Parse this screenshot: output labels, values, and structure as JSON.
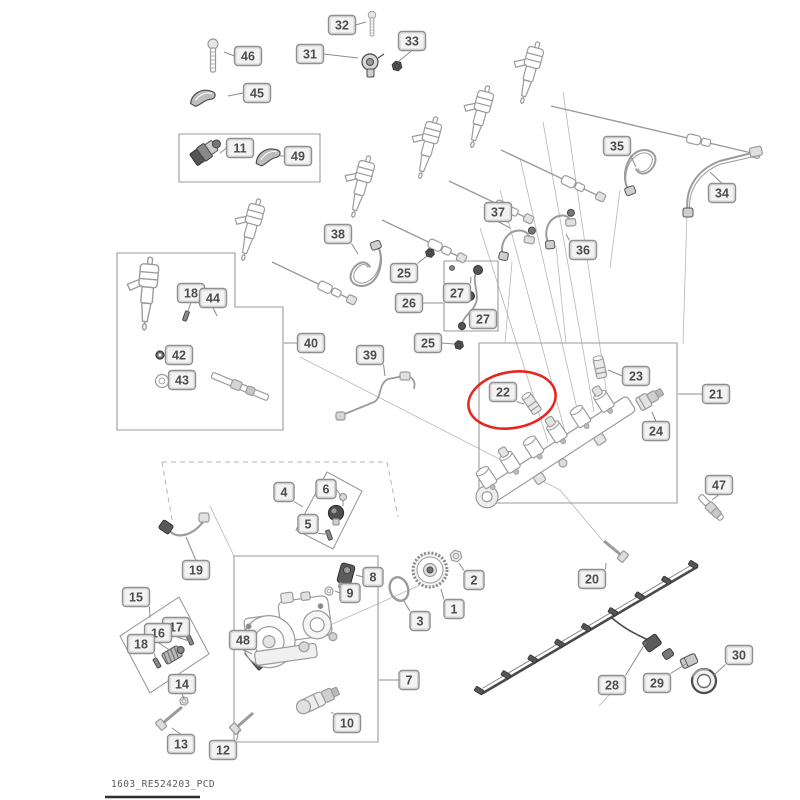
{
  "title": "Fuel system exploded parts diagram",
  "footer": {
    "doc_code": "1603_RE524203_PCD"
  },
  "colors": {
    "line": "#9b9b9b",
    "dark": "#4a4a4a",
    "construction": "#b6b6b6",
    "label_fill": "#f3f3f3",
    "label_stroke": "#8f8f8f",
    "label_inner": "#cfcfcf",
    "label_text": "#4c4c4c",
    "highlight_red": "#e8251f",
    "footer_rule": "#2f2f2f"
  },
  "highlight": {
    "label": "22",
    "cx": 512,
    "cy": 400,
    "rx": 44,
    "ry": 28,
    "rot": -10
  },
  "labels": [
    {
      "id": "46",
      "x": 248,
      "y": 56,
      "tx": 224,
      "ty": 52
    },
    {
      "id": "45",
      "x": 257,
      "y": 93,
      "tx": 228,
      "ty": 96
    },
    {
      "id": "32",
      "x": 342,
      "y": 25,
      "tx": 366,
      "ty": 22
    },
    {
      "id": "31",
      "x": 310,
      "y": 54,
      "tx": 358,
      "ty": 58
    },
    {
      "id": "33",
      "x": 412,
      "y": 41,
      "tx": 399,
      "ty": 61
    },
    {
      "id": "11",
      "x": 240,
      "y": 148,
      "tx": 220,
      "ty": 153
    },
    {
      "id": "49",
      "x": 298,
      "y": 156,
      "tx": 280,
      "ty": 156
    },
    {
      "id": "35",
      "x": 617,
      "y": 146,
      "tx": 636,
      "ty": 167
    },
    {
      "id": "34",
      "x": 722,
      "y": 193,
      "tx": 710,
      "ty": 172
    },
    {
      "id": "37",
      "x": 498,
      "y": 212,
      "tx": 510,
      "ty": 228
    },
    {
      "id": "36",
      "x": 583,
      "y": 250,
      "tx": 566,
      "ty": 234
    },
    {
      "id": "38",
      "x": 338,
      "y": 234,
      "tx": 358,
      "ty": 254
    },
    {
      "id": "25",
      "x": 404,
      "y": 273,
      "tx": 427,
      "ty": 256
    },
    {
      "id": "27",
      "x": 457,
      "y": 293,
      "tx": 471,
      "ty": 277
    },
    {
      "id": "26",
      "x": 409,
      "y": 303,
      "tx": 443,
      "ty": 303
    },
    {
      "id": "27",
      "x": 483,
      "y": 319,
      "tx": 470,
      "ty": 326
    },
    {
      "id": "25",
      "x": 428,
      "y": 343,
      "tx": 454,
      "ty": 344
    },
    {
      "id": "39",
      "x": 370,
      "y": 355,
      "tx": 385,
      "ty": 376
    },
    {
      "id": "40",
      "x": 311,
      "y": 343,
      "tx": 284,
      "ty": 343
    },
    {
      "id": "18",
      "x": 191,
      "y": 293,
      "tx": 187,
      "ty": 314
    },
    {
      "id": "44",
      "x": 213,
      "y": 298,
      "tx": 217,
      "ty": 316
    },
    {
      "id": "42",
      "x": 179,
      "y": 355,
      "tx": 166,
      "ty": 355
    },
    {
      "id": "43",
      "x": 182,
      "y": 380,
      "tx": 170,
      "ty": 381
    },
    {
      "id": "22",
      "x": 503,
      "y": 392,
      "tx": 524,
      "ty": 404
    },
    {
      "id": "23",
      "x": 636,
      "y": 376,
      "tx": 608,
      "ty": 370
    },
    {
      "id": "21",
      "x": 716,
      "y": 394,
      "tx": 678,
      "ty": 394
    },
    {
      "id": "24",
      "x": 656,
      "y": 431,
      "tx": 652,
      "ty": 412
    },
    {
      "id": "47",
      "x": 719,
      "y": 485,
      "tx": 712,
      "ty": 500
    },
    {
      "id": "19",
      "x": 196,
      "y": 570,
      "tx": 186,
      "ty": 537
    },
    {
      "id": "15",
      "x": 136,
      "y": 597,
      "tx": 150,
      "ty": 618
    },
    {
      "id": "17",
      "x": 176,
      "y": 627,
      "tx": 189,
      "ty": 641
    },
    {
      "id": "16",
      "x": 158,
      "y": 633,
      "tx": 171,
      "ty": 651
    },
    {
      "id": "18",
      "x": 141,
      "y": 644,
      "tx": 156,
      "ty": 662
    },
    {
      "id": "48",
      "x": 243,
      "y": 640,
      "tx": 252,
      "ty": 654
    },
    {
      "id": "14",
      "x": 182,
      "y": 684,
      "tx": 184,
      "ty": 699
    },
    {
      "id": "13",
      "x": 181,
      "y": 744,
      "tx": 172,
      "ty": 728
    },
    {
      "id": "12",
      "x": 223,
      "y": 750,
      "tx": 239,
      "ty": 730
    },
    {
      "id": "4",
      "x": 284,
      "y": 492,
      "tx": 303,
      "ty": 507
    },
    {
      "id": "6",
      "x": 326,
      "y": 489,
      "tx": 341,
      "ty": 496
    },
    {
      "id": "5",
      "x": 308,
      "y": 524,
      "tx": 327,
      "ty": 534
    },
    {
      "id": "8",
      "x": 373,
      "y": 577,
      "tx": 356,
      "ty": 575
    },
    {
      "id": "9",
      "x": 350,
      "y": 593,
      "tx": 335,
      "ty": 591
    },
    {
      "id": "2",
      "x": 474,
      "y": 580,
      "tx": 459,
      "ty": 563
    },
    {
      "id": "1",
      "x": 454,
      "y": 609,
      "tx": 441,
      "ty": 589
    },
    {
      "id": "3",
      "x": 420,
      "y": 621,
      "tx": 404,
      "ty": 601
    },
    {
      "id": "7",
      "x": 409,
      "y": 680,
      "tx": 379,
      "ty": 680
    },
    {
      "id": "10",
      "x": 347,
      "y": 723,
      "tx": 331,
      "ty": 712
    },
    {
      "id": "20",
      "x": 592,
      "y": 579,
      "tx": 606,
      "ty": 563
    },
    {
      "id": "28",
      "x": 612,
      "y": 685,
      "tx": 646,
      "ty": 642
    },
    {
      "id": "29",
      "x": 657,
      "y": 683,
      "tx": 686,
      "ty": 664
    },
    {
      "id": "30",
      "x": 739,
      "y": 655,
      "tx": 713,
      "ty": 676
    }
  ],
  "group_boxes": [
    {
      "name": "group-box-11-49",
      "points": "179,134 320,134 320,182 179,182"
    },
    {
      "name": "group-box-40",
      "points": "117,253 235,253 235,307 283,307 283,430 117,430"
    },
    {
      "name": "group-box-26-27",
      "points": "444,261 498,261 498,331 444,331"
    },
    {
      "name": "group-box-21",
      "points": "479,343 677,343 677,503 479,503"
    },
    {
      "name": "group-box-7",
      "points": "234,556 378,556 378,742 234,742"
    },
    {
      "name": "group-box-15-18",
      "points": "120,636 179,597 209,654 150,693"
    },
    {
      "name": "group-box-4-5-6",
      "points": "296,530 327,472 362,491 333,549"
    }
  ],
  "dashed_lines": [
    [
      162,
      462,
      387,
      462
    ],
    [
      387,
      462,
      398,
      517
    ],
    [
      162,
      462,
      172,
      520
    ]
  ],
  "construction_lines": [
    [
      500,
      190,
      565,
      432
    ],
    [
      520,
      158,
      580,
      422
    ],
    [
      543,
      122,
      594,
      412
    ],
    [
      563,
      92,
      608,
      402
    ],
    [
      480,
      228,
      548,
      442
    ],
    [
      300,
      357,
      560,
      490
    ],
    [
      560,
      490,
      603,
      541
    ],
    [
      420,
      585,
      252,
      660
    ],
    [
      210,
      506,
      234,
      556
    ],
    [
      612,
      692,
      599,
      706
    ],
    [
      687,
      212,
      683,
      344
    ],
    [
      620,
      190,
      610,
      268
    ],
    [
      512,
      262,
      505,
      343
    ],
    [
      556,
      246,
      566,
      343
    ]
  ],
  "parts": [
    {
      "kind": "bolt-v",
      "name": "bolt-46",
      "x": 213,
      "y": 44,
      "s": 1
    },
    {
      "kind": "clamp",
      "name": "clamp-45",
      "x": 203,
      "y": 96,
      "rot": -15
    },
    {
      "kind": "bolt-v",
      "name": "bolt-32",
      "x": 372,
      "y": 15,
      "s": 0.75
    },
    {
      "kind": "sensor-round",
      "name": "sensor-31",
      "x": 370,
      "y": 62
    },
    {
      "kind": "nut",
      "name": "nut-33",
      "x": 397,
      "y": 66,
      "r": 5,
      "dark": 1
    },
    {
      "kind": "sensor-cyl",
      "name": "sensor-11",
      "x": 205,
      "y": 152,
      "rot": -35
    },
    {
      "kind": "clamp",
      "name": "clamp-49",
      "x": 268,
      "y": 155,
      "rot": -20
    },
    {
      "kind": "injector",
      "name": "fuel-injector",
      "x": 258,
      "y": 203,
      "rot": 15,
      "s": 1
    },
    {
      "kind": "injector",
      "name": "fuel-injector",
      "x": 368,
      "y": 160,
      "rot": 15,
      "s": 1
    },
    {
      "kind": "injector",
      "name": "fuel-injector",
      "x": 435,
      "y": 121,
      "rot": 15,
      "s": 1
    },
    {
      "kind": "injector",
      "name": "fuel-injector",
      "x": 487,
      "y": 90,
      "rot": 15,
      "s": 1
    },
    {
      "kind": "injector",
      "name": "fuel-injector",
      "x": 537,
      "y": 46,
      "rot": 15,
      "s": 1
    },
    {
      "kind": "fline",
      "name": "injection-line",
      "x1": 272,
      "y1": 262,
      "x2": 352,
      "y2": 300
    },
    {
      "kind": "fline",
      "name": "injection-line",
      "x1": 382,
      "y1": 220,
      "x2": 462,
      "y2": 258
    },
    {
      "kind": "fline",
      "name": "injection-line",
      "x1": 449,
      "y1": 181,
      "x2": 529,
      "y2": 219
    },
    {
      "kind": "fline",
      "name": "injection-line",
      "x1": 501,
      "y1": 150,
      "x2": 601,
      "y2": 197
    },
    {
      "kind": "fline",
      "name": "injection-line",
      "x1": 551,
      "y1": 106,
      "x2": 756,
      "y2": 154
    },
    {
      "kind": "loop-hose",
      "name": "hose-35",
      "x": 640,
      "y": 168,
      "rot": -20
    },
    {
      "kind": "hose-34",
      "name": "hose-34"
    },
    {
      "kind": "hose-s",
      "name": "hose-37",
      "x": 516,
      "y": 240,
      "rot": 10
    },
    {
      "kind": "hose-s",
      "name": "hose-36",
      "x": 558,
      "y": 226,
      "rot": -5
    },
    {
      "kind": "loop-hose",
      "name": "hose-38",
      "x": 366,
      "y": 268,
      "rot": 160
    },
    {
      "kind": "nut",
      "name": "nut-25",
      "x": 430,
      "y": 253,
      "r": 4.5,
      "dark": 1
    },
    {
      "kind": "pipe-27",
      "name": "leak-off-pipe-26-27"
    },
    {
      "kind": "nut",
      "name": "nut-25",
      "x": 459,
      "y": 345,
      "r": 4.5,
      "dark": 1
    },
    {
      "kind": "pipe-39",
      "name": "fuel-pipe-39"
    },
    {
      "kind": "injector",
      "name": "fuel-injector-40",
      "x": 150,
      "y": 262,
      "rot": 5,
      "s": 1.15
    },
    {
      "kind": "pin",
      "name": "pin-18",
      "x": 186,
      "y": 316,
      "rot": 20
    },
    {
      "kind": "bushing",
      "name": "bushing-44",
      "x": 219,
      "y": 326
    },
    {
      "kind": "washer",
      "name": "washer-42",
      "x": 160,
      "y": 355,
      "r": 4,
      "dark": 1
    },
    {
      "kind": "washer",
      "name": "washer-43",
      "x": 162,
      "y": 381,
      "r": 6.5
    },
    {
      "kind": "rod",
      "name": "shaft-40",
      "x1": 212,
      "y1": 375,
      "x2": 268,
      "y2": 398
    },
    {
      "kind": "rail",
      "name": "fuel-rail-21"
    },
    {
      "kind": "fitting",
      "name": "fitting-22",
      "x": 532,
      "y": 404,
      "rot": -35
    },
    {
      "kind": "fitting",
      "name": "fitting-23",
      "x": 600,
      "y": 368,
      "rot": -12
    },
    {
      "kind": "fitting2",
      "name": "sensor-24",
      "x": 649,
      "y": 399,
      "rot": -30
    },
    {
      "kind": "rod",
      "name": "pin-47",
      "x1": 700,
      "y1": 496,
      "x2": 722,
      "y2": 519
    },
    {
      "kind": "hose-19",
      "name": "hose-19"
    },
    {
      "kind": "spring",
      "name": "element-16",
      "x": 172,
      "y": 655,
      "rot": -30
    },
    {
      "kind": "pin",
      "name": "pin-17",
      "x": 190,
      "y": 640,
      "rot": -25
    },
    {
      "kind": "pin",
      "name": "pin-18b",
      "x": 157,
      "y": 663,
      "rot": -30
    },
    {
      "kind": "stud",
      "name": "stud-48",
      "x": 254,
      "y": 660,
      "rot": -40
    },
    {
      "kind": "nut",
      "name": "nut-14",
      "x": 184,
      "y": 701,
      "r": 4.5
    },
    {
      "kind": "bolt-d",
      "name": "bolt-13",
      "x1": 163,
      "y1": 723,
      "x2": 182,
      "y2": 707
    },
    {
      "kind": "bolt-d",
      "name": "bolt-12",
      "x1": 237,
      "y1": 727,
      "x2": 253,
      "y2": 713
    },
    {
      "kind": "screw",
      "name": "screw-6",
      "x": 343,
      "y": 497
    },
    {
      "kind": "pin",
      "name": "pin-5",
      "x": 329,
      "y": 535,
      "rot": -20
    },
    {
      "kind": "valve",
      "name": "valve-4",
      "x": 336,
      "y": 513
    },
    {
      "kind": "part8",
      "name": "fitting-8",
      "x": 346,
      "y": 574,
      "rot": 15
    },
    {
      "kind": "washer",
      "name": "washer-9",
      "x": 329,
      "y": 591,
      "r": 4
    },
    {
      "kind": "nut",
      "name": "nut-2",
      "x": 456,
      "y": 556,
      "r": 6
    },
    {
      "kind": "gear",
      "name": "drive-gear-1",
      "x": 430,
      "y": 570
    },
    {
      "kind": "oring",
      "name": "o-ring-3",
      "x": 399,
      "y": 589
    },
    {
      "kind": "pump",
      "name": "injection-pump-7"
    },
    {
      "kind": "solenoid",
      "name": "solenoid-10",
      "x": 318,
      "y": 700,
      "rot": -25
    },
    {
      "kind": "bolt-d",
      "name": "bolt-20",
      "x1": 621,
      "y1": 555,
      "x2": 604,
      "y2": 541
    },
    {
      "kind": "harness",
      "name": "wiring-harness-28"
    },
    {
      "kind": "cyl",
      "name": "connector-29",
      "x": 689,
      "y": 661,
      "rot": -25
    },
    {
      "kind": "cap",
      "name": "cap-30",
      "x": 704,
      "y": 681
    }
  ],
  "footer_rule": {
    "x1": 105,
    "y1": 797,
    "x2": 200,
    "y2": 797
  }
}
